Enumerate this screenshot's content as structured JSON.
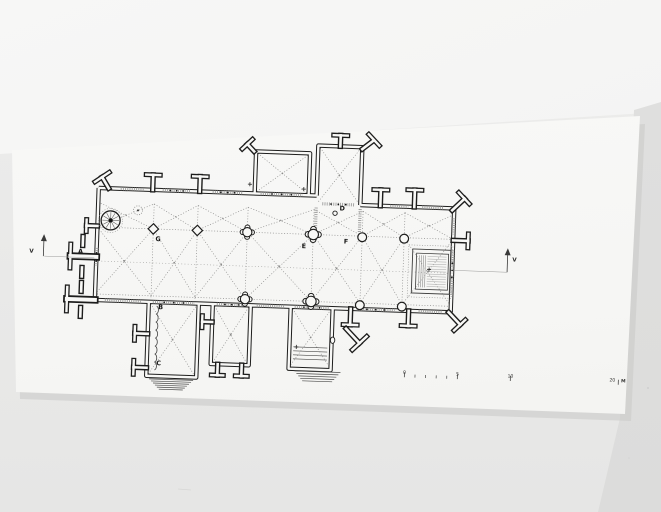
{
  "photo": {
    "background_color": "#e9e9e8",
    "top_area_color": "#f5f5f4",
    "right_band_color": "#dfdfde",
    "sheet_color": "#f7f7f5",
    "shadow_color": "#c9c9c7"
  },
  "plan": {
    "colors": {
      "wall": "#1d1d1c",
      "wall_fill": "#f8f8f6",
      "opening": "#9d9d9c",
      "rib": "#8b8b8a",
      "ink": "#161615"
    },
    "labels": [
      {
        "id": "A",
        "text": "A"
      },
      {
        "id": "B",
        "text": "B"
      },
      {
        "id": "C",
        "text": "C"
      },
      {
        "id": "D",
        "text": "D"
      },
      {
        "id": "E",
        "text": "E"
      },
      {
        "id": "F",
        "text": "F"
      },
      {
        "id": "G",
        "text": "G"
      }
    ],
    "section_marker": "V",
    "cross_mark": "+"
  },
  "scale_bar": {
    "tick_labels": [
      "0",
      "5",
      "10",
      "20"
    ],
    "unit": "M"
  }
}
